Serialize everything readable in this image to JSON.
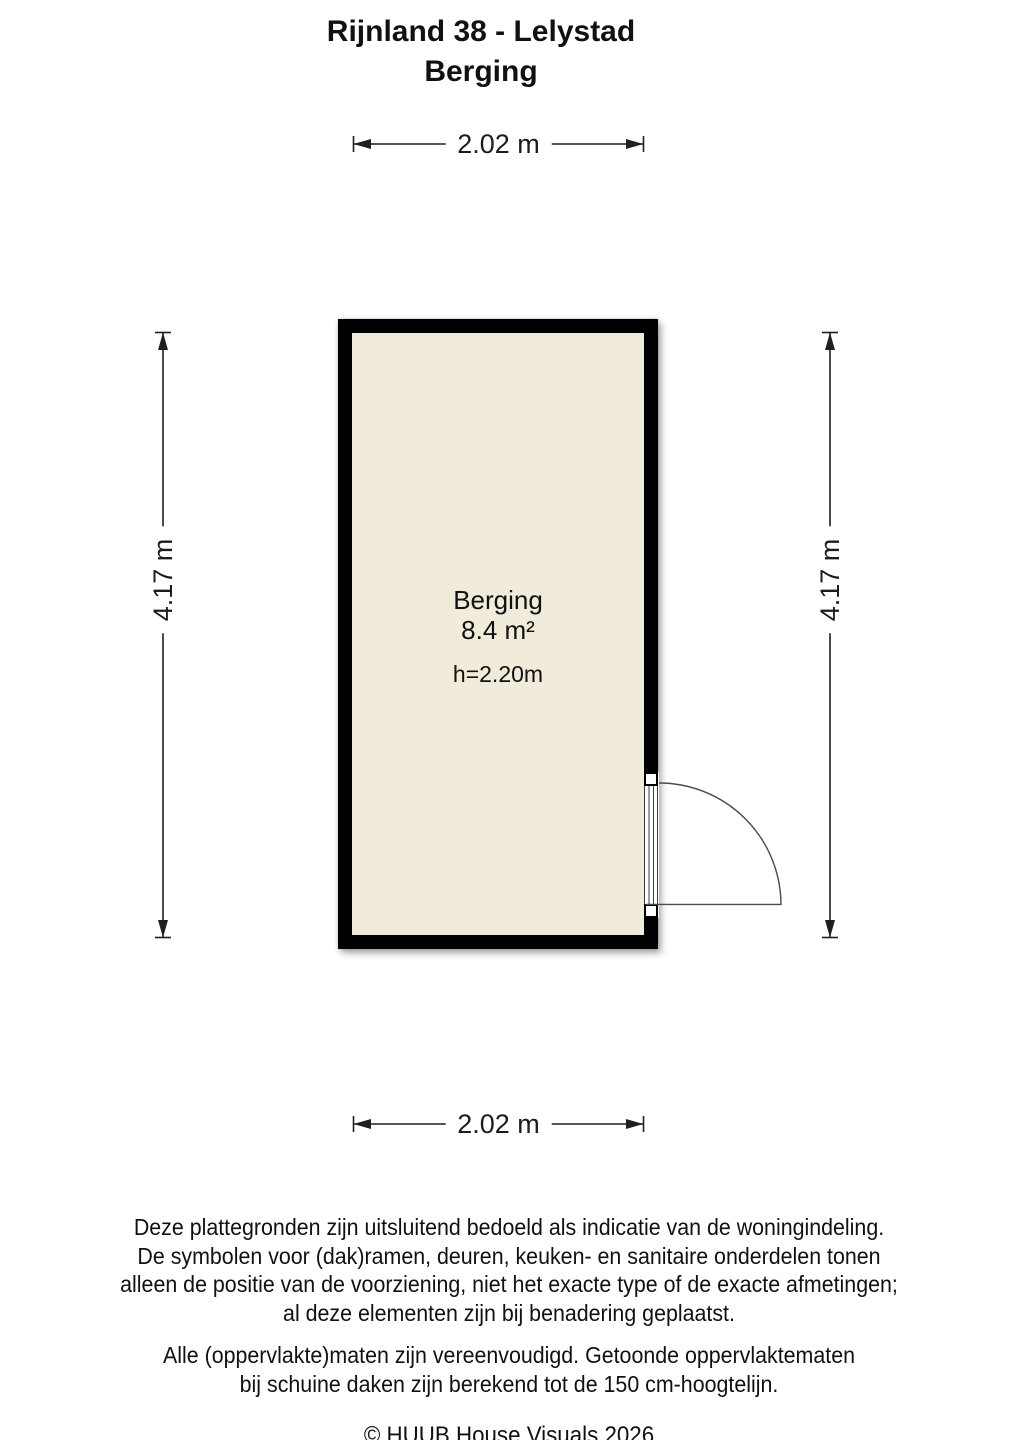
{
  "title": {
    "line1": "Rijnland 38 - Lelystad",
    "line2": "Berging"
  },
  "dimensions": {
    "top": "2.02 m",
    "bottom": "2.02 m",
    "left": "4.17 m",
    "right": "4.17 m"
  },
  "floor_plan": {
    "room": {
      "name": "Berging",
      "area": "8.4 m²",
      "ceiling_height": "h=2.20m"
    },
    "colors": {
      "wall": "#000000",
      "floor_fill": "#F0EBDB",
      "dimension_line": "#1f1f1f",
      "door_line": "#4a4a4a"
    }
  },
  "footer": {
    "disclaimer1": "Deze plattegronden zijn uitsluitend bedoeld als indicatie van de woningindeling.\nDe symbolen voor (dak)ramen, deuren, keuken- en sanitaire onderdelen tonen\nalleen de positie van de voorziening, niet het exacte type of de exacte afmetingen;\nal deze elementen zijn bij benadering geplaatst.",
    "disclaimer2": "Alle (oppervlakte)maten zijn vereenvoudigd. Getoonde oppervlaktematen\nbij schuine daken zijn berekend tot de 150 cm-hoogtelijn.",
    "copyright": "© HUUB House Visuals 2026"
  }
}
